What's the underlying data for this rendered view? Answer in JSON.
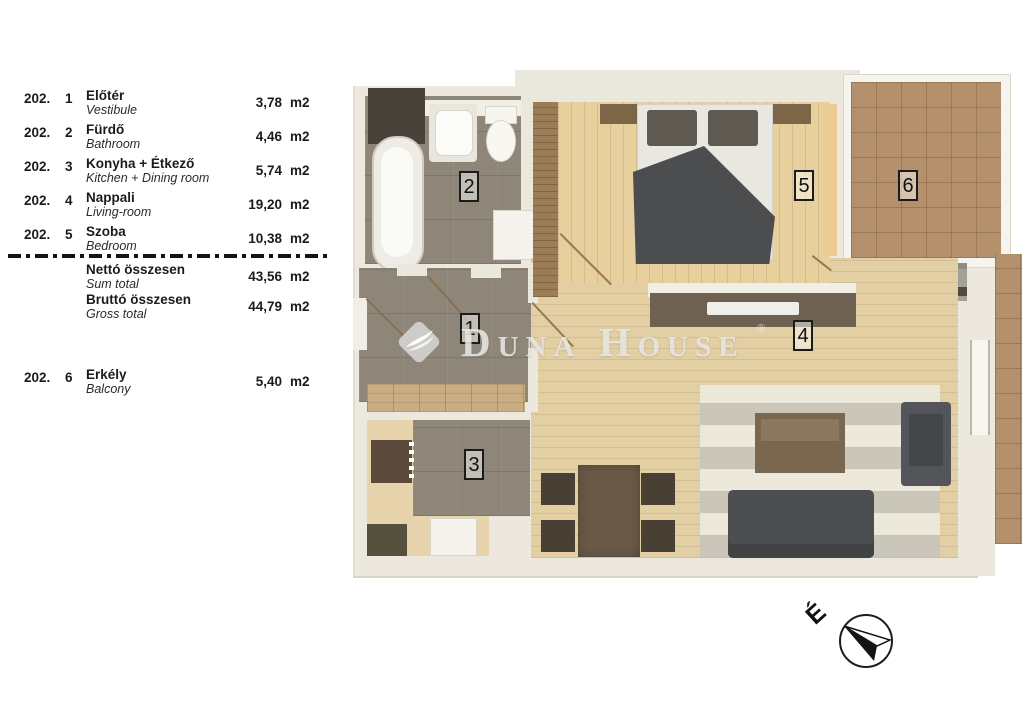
{
  "legend": {
    "rows": [
      {
        "code": "202.",
        "index": "1",
        "name_hu": "Előtér",
        "name_en": "Vestibule",
        "area": "3,78",
        "unit": "m2"
      },
      {
        "code": "202.",
        "index": "2",
        "name_hu": "Fürdő",
        "name_en": "Bathroom",
        "area": "4,46",
        "unit": "m2"
      },
      {
        "code": "202.",
        "index": "3",
        "name_hu": "Konyha + Étkező",
        "name_en": "Kitchen + Dining room",
        "area": "5,74",
        "unit": "m2"
      },
      {
        "code": "202.",
        "index": "4",
        "name_hu": "Nappali",
        "name_en": "Living-room",
        "area": "19,20",
        "unit": "m2"
      },
      {
        "code": "202.",
        "index": "5",
        "name_hu": "Szoba",
        "name_en": "Bedroom",
        "area": "10,38",
        "unit": "m2"
      }
    ],
    "totals": [
      {
        "name_hu": "Nettó összesen",
        "name_en": "Sum total",
        "area": "43,56",
        "unit": "m2"
      },
      {
        "name_hu": "Bruttó összesen",
        "name_en": "Gross total",
        "area": "44,79",
        "unit": "m2"
      }
    ],
    "balcony": {
      "code": "202.",
      "index": "6",
      "name_hu": "Erkély",
      "name_en": "Balcony",
      "area": "5,40",
      "unit": "m2"
    }
  },
  "floorplan": {
    "room_numbers": [
      "1",
      "2",
      "3",
      "4",
      "5",
      "6"
    ]
  },
  "watermark": {
    "brand": "Duna House",
    "mark": "®"
  },
  "compass": {
    "north_label": "É"
  },
  "colors": {
    "wall_cream": "#ece8dd",
    "tile_gray": "#8e8779",
    "wood_floor": "#e3cfa4",
    "balcony_tile": "#b4906c",
    "furniture_dark": "#4d4e50",
    "furniture_wood": "#6e6152"
  }
}
